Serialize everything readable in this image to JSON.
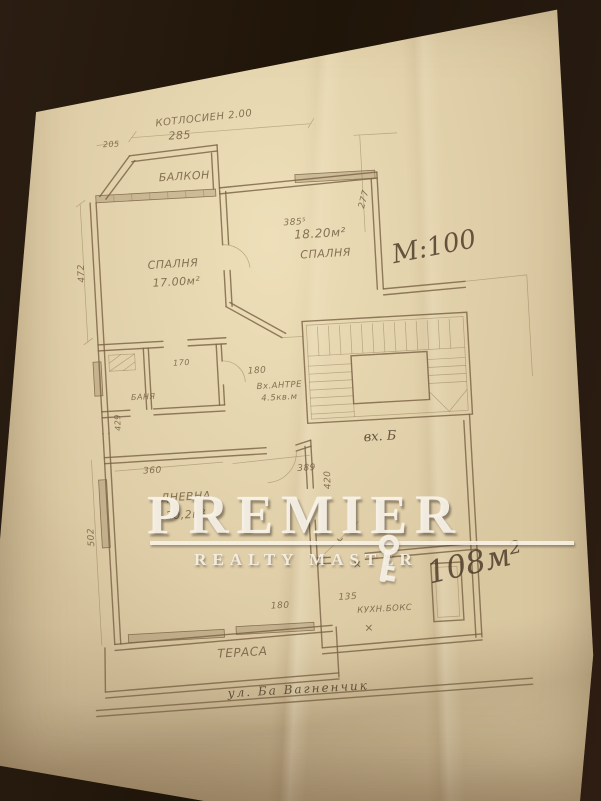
{
  "photo": {
    "background_color": "#261a11",
    "paper_color": "#d9c7a0"
  },
  "watermark": {
    "brand": "PREMIER",
    "tagline": "REALTY MASTER",
    "color": "#f7f1e3",
    "key_icon": "key-icon"
  },
  "notes": {
    "top": "КОТЛОСИЕН 2.00",
    "scale": "М:100",
    "total_area": "108м²",
    "entrance": "вх. Б",
    "street": "ул. Ба Вагненчик"
  },
  "rooms": {
    "balcony": "БАЛКОН",
    "bedroom_left": {
      "name": "СПАЛНЯ",
      "area": "17.00м²"
    },
    "bedroom_right": {
      "name": "СПАЛНЯ",
      "area": "18.20м²"
    },
    "bath": "БАНЯ",
    "entry_hall": {
      "name": "Вх.АНТРЕ",
      "area": "4.5кв.м"
    },
    "living": {
      "name": "ДНЕВНА",
      "area": "20,2м²"
    },
    "kitchen": "КУХН.БОКС",
    "terrace": "ТЕРАСА"
  },
  "dims": {
    "d285": "285",
    "d205": "205",
    "d385": "385⁵",
    "d277": "277",
    "d472": "472",
    "d429": "429",
    "d502": "502",
    "d420": "420",
    "d360": "360",
    "d389": "389",
    "d170": "170",
    "d180a": "180",
    "d180b": "180",
    "d135": "135"
  },
  "marks": {
    "x1": "×",
    "x2": "×",
    "x3": "×"
  }
}
